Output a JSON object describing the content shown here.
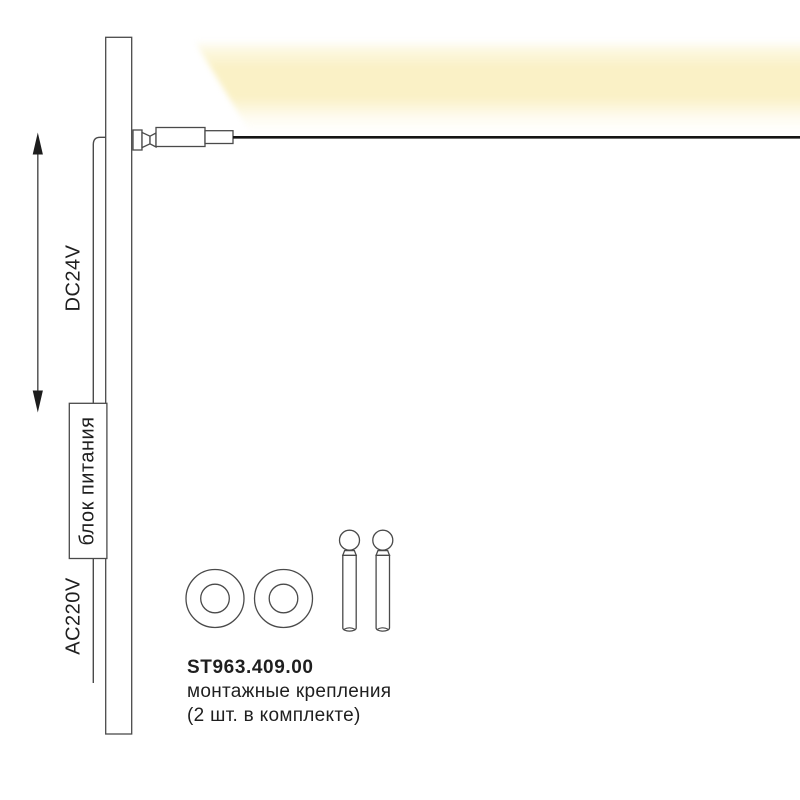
{
  "colors": {
    "glow": "#FAF1C6",
    "line": "#4A4A4A",
    "cable": "#151515",
    "text": "#1F1F1F"
  },
  "labels": {
    "dc_voltage": "DC24V",
    "power_supply": "блок питания",
    "ac_voltage": "AC220V"
  },
  "product": {
    "code": "ST963.409.00",
    "line1": "монтажные крепления",
    "line2": "(2 шт. в комплекте)"
  }
}
